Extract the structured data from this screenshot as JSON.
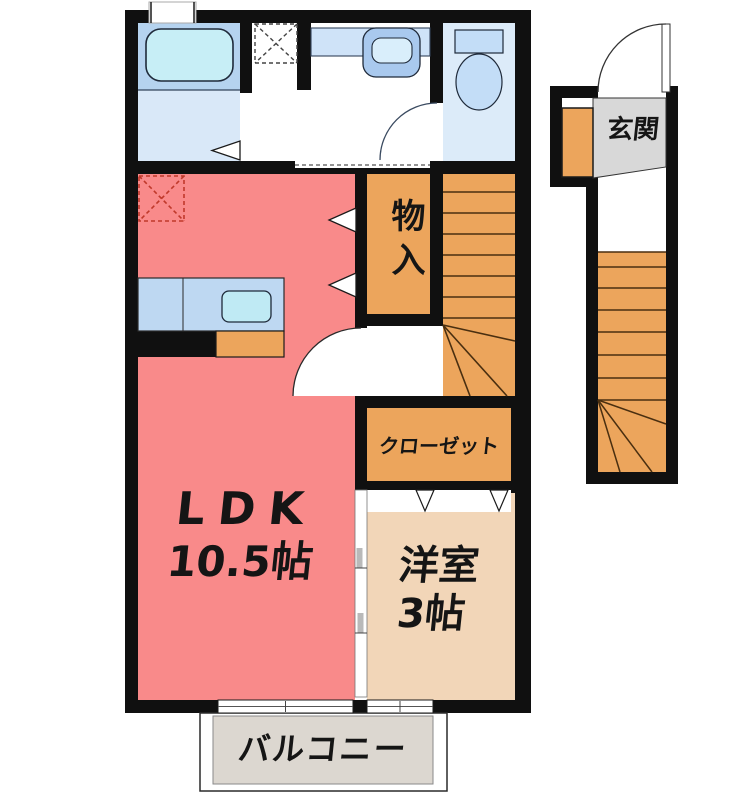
{
  "rooms": {
    "ldk": {
      "label": "LDK",
      "size": "10.5帖"
    },
    "western_room": {
      "label": "洋室",
      "size": "3帖"
    },
    "storage": {
      "label": "物入"
    },
    "closet": {
      "label": "クローゼット"
    },
    "entrance": {
      "label": "玄関"
    },
    "balcony": {
      "label": "バルコニー"
    }
  },
  "colors": {
    "wall": "#101010",
    "ldk_floor": "#f98a8a",
    "western_floor": "#f2d6b8",
    "wood_orange": "#eca55c",
    "balcony_floor": "#dcd7d0",
    "entrance_floor": "#d8d8d8",
    "bath_zone": "#b5d3ef",
    "bath_floor": "#d9e8f8",
    "bathtub": "#c7eef6",
    "toilet_floor": "#dcebf9",
    "fixture_blue": "#c3ddf7",
    "vanity_counter": "#cfe3f8",
    "kitchen_counter": "#bed8f2",
    "kitchen_sink": "#bfeaf4",
    "step_line": "#4a2f10",
    "dashed_marker_red": "#c0392b"
  }
}
